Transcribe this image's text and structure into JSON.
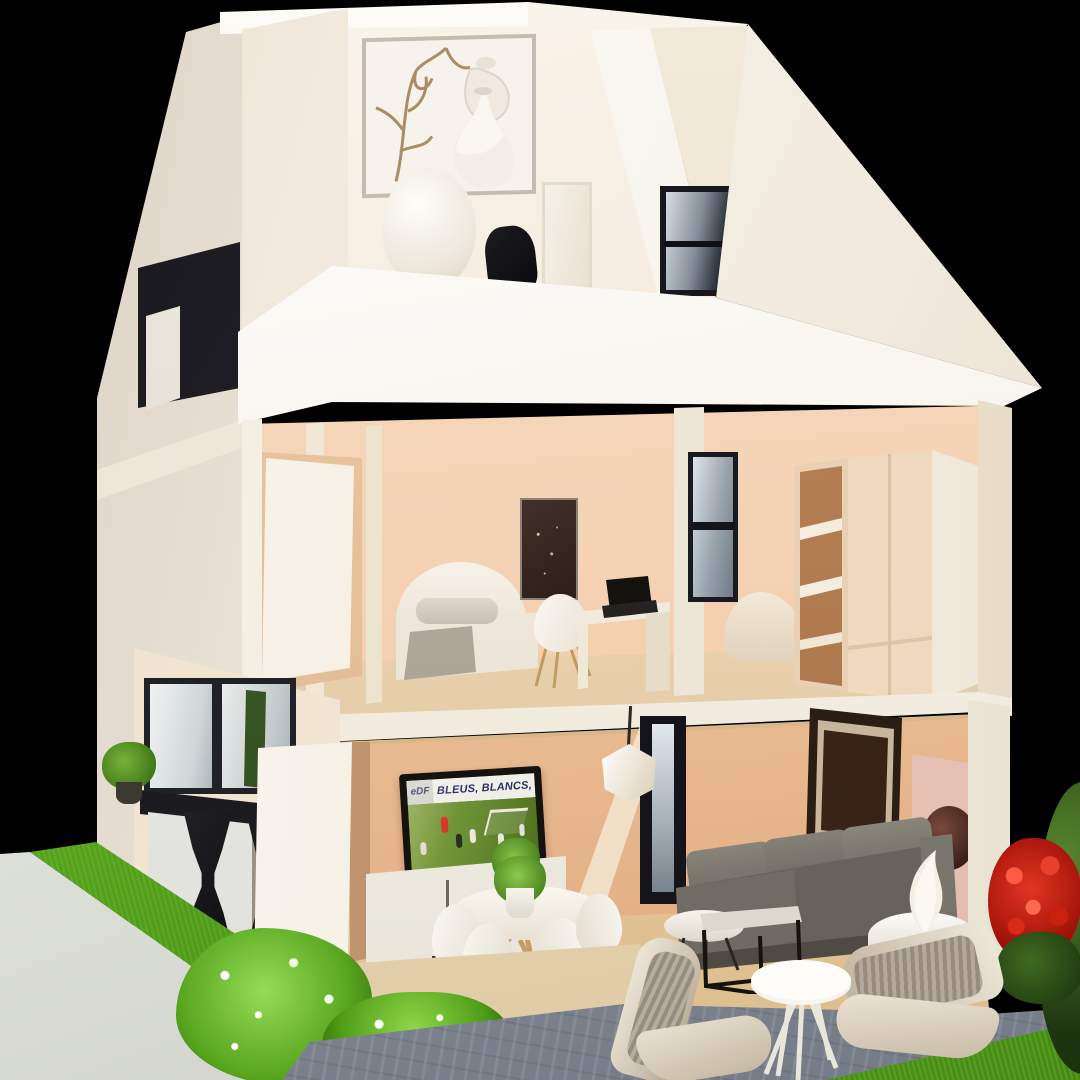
{
  "scene": {
    "type": "photograph",
    "subject": "Cross-section architectural scale model of a three-story house with furnished interiors, garden, patio and black studio background",
    "floors": [
      "attic bedroom with vases and framed branch art",
      "middle floor: bedroom with bed, desk, laptop, wardrobe",
      "ground floor: kitchen, TV lounge, dining set, grey sofa",
      "outdoor: grass, white retaining wall, paved patio with benches, red flowering shrub"
    ]
  },
  "tv": {
    "banner_text": "BLEUS, BLANCS,",
    "board_text": "eDF"
  },
  "palette": {
    "background": "#000000",
    "roof_white": "#f7f3ea",
    "wall_peach": "#f3cdab",
    "wall_cream": "#f3ecdf",
    "wood_floor": "#e8d2b0",
    "sofa_gray": "#75706a",
    "grass_green": "#5aad1d",
    "patio_gray": "#8f96a1",
    "flower_red": "#cf2118",
    "pitch_green": "#6b8f33"
  }
}
